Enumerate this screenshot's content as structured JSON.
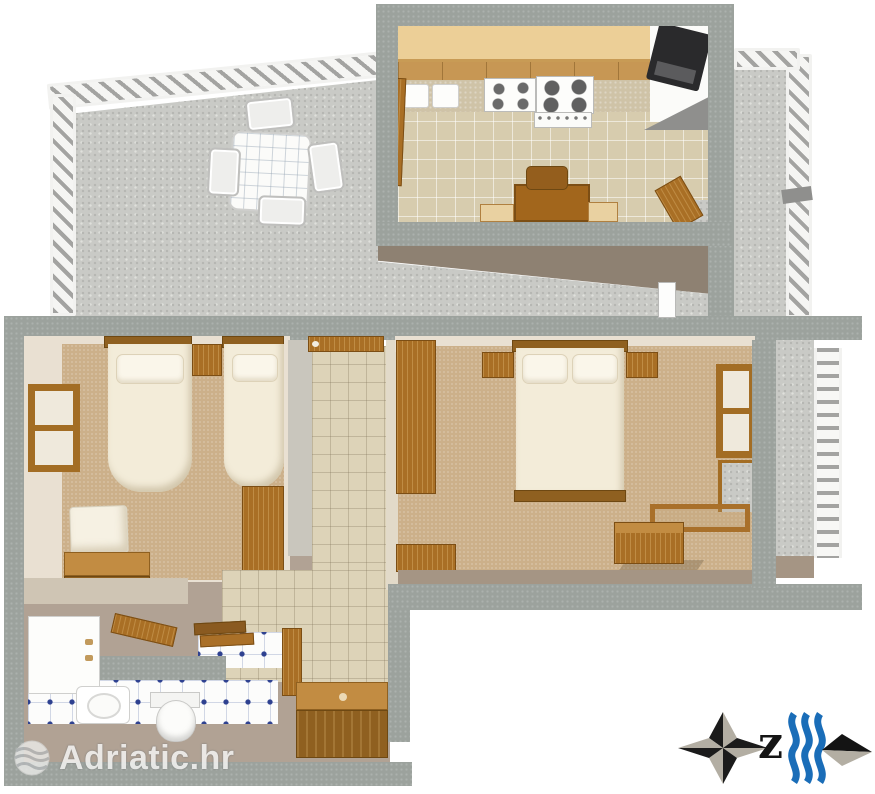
{
  "watermark": {
    "text": "Adriatic.hr",
    "icon": "globe-waves-icon"
  },
  "compass": {
    "label": "z",
    "icon": "compass-rose-icon"
  },
  "icons": {
    "brand_globe": "globe-waves-icon",
    "compass_rose": "compass-rose-icon",
    "sea_waves": "sea-waves-icon",
    "direction_arrow": "direction-diamond-icon"
  },
  "palette": {
    "wall_gray": "#9ca29d",
    "stone_gray": "#c9cac6",
    "wood_brown": "#a96f25",
    "wood_light": "#c28c42",
    "counter_wood": "#eccf97",
    "kitchen_tile": "#d7ccae",
    "hall_tile": "#ddd3b8",
    "carpet_tan": "#ccb08a",
    "cream_wall": "#e9e0d2",
    "taupe_floor": "#b1a294",
    "bed_white": "#f3ecd9",
    "bath_tile_dot_blue": "#2e4190",
    "sea_wave_blue": "#1a6db8",
    "compass_black": "#1b1b1b",
    "compass_tan": "#b3aea3"
  }
}
